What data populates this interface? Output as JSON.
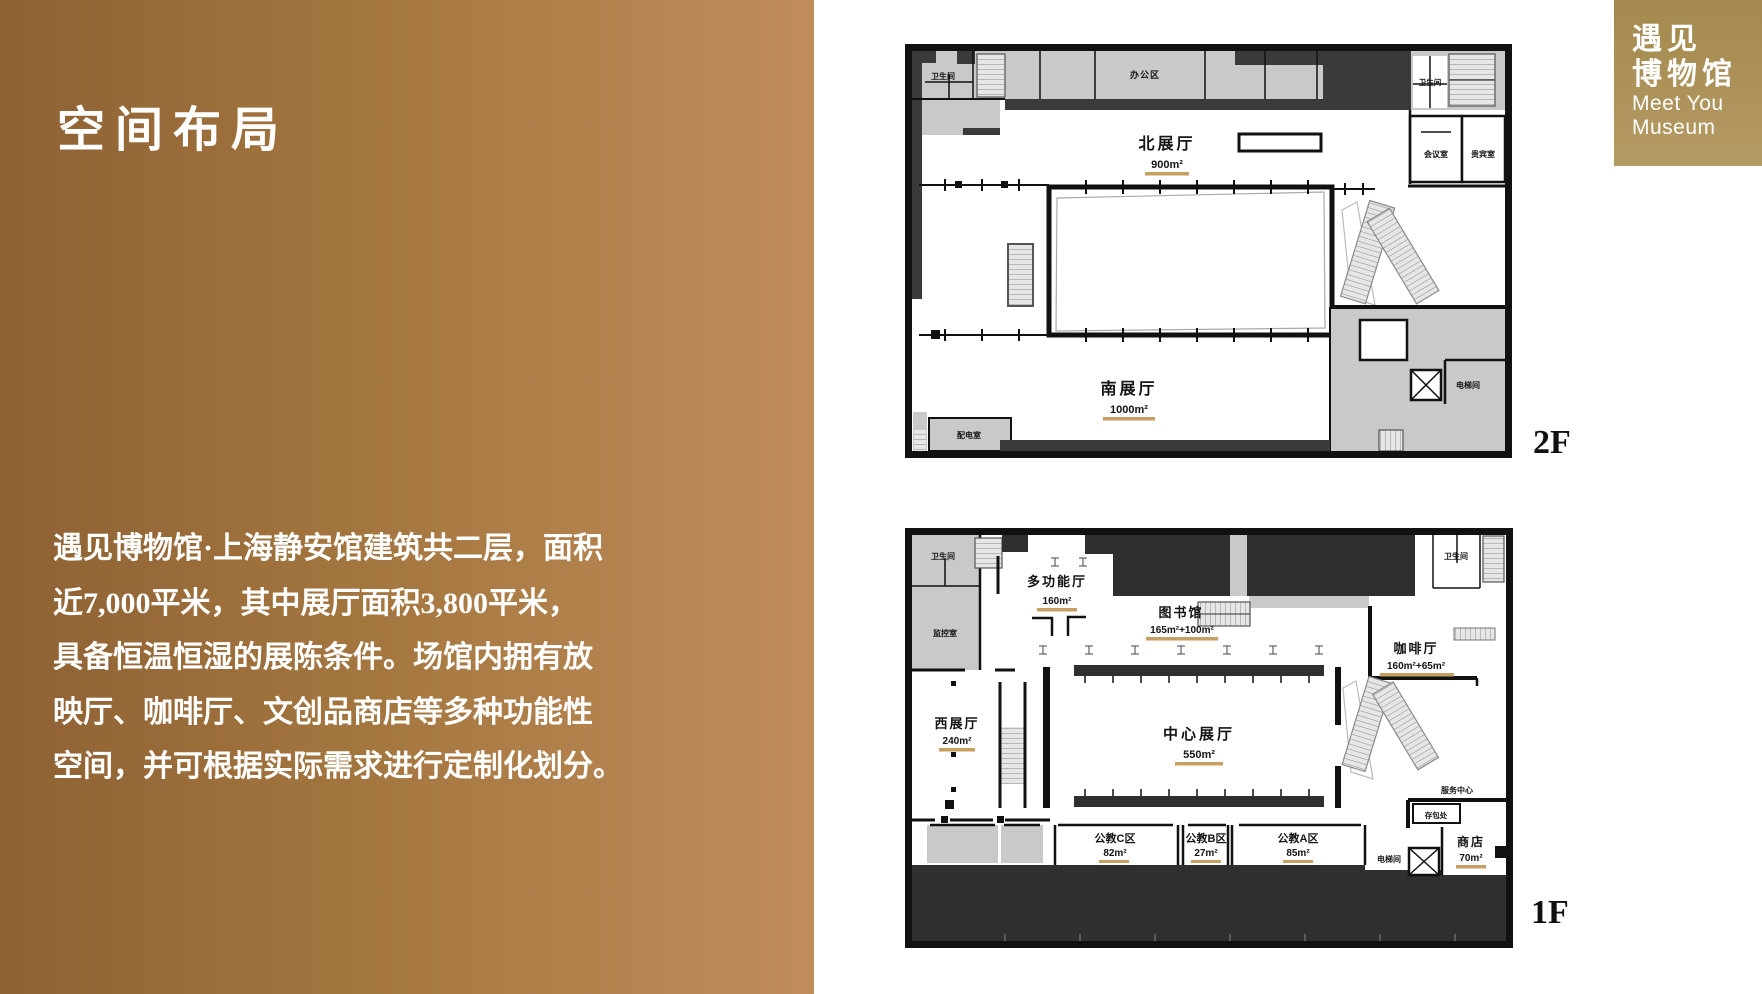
{
  "left_panel": {
    "title": "空间布局",
    "paragraph_lines": [
      "遇见博物馆·上海静安馆建筑共二层，面积",
      "近7,000平米，其中展厅面积3,800平米，",
      "具备恒温恒湿的展陈条件。场馆内拥有放",
      "映厅、咖啡厅、文创品商店等多种功能性",
      "空间，并可根据实际需求进行定制化划分。"
    ]
  },
  "logo": {
    "cn_line1": "遇见",
    "cn_line2": "博物馆",
    "en_line1": "Meet You",
    "en_line2": "Museum"
  },
  "floor2": {
    "floor_label": "2F",
    "rooms": {
      "toilet_left": "卫生间",
      "office": "办公区",
      "toilet_right": "卫生间",
      "meeting": "会议室",
      "vip": "贵宾室",
      "north_hall": {
        "name": "北展厅",
        "area": "900m²"
      },
      "south_hall": {
        "name": "南展厅",
        "area": "1000m²"
      },
      "power": "配电室",
      "elevator": "电梯间"
    }
  },
  "floor1": {
    "floor_label": "1F",
    "rooms": {
      "toilet_left": "卫生间",
      "monitor": "监控室",
      "multi_hall": {
        "name": "多功能厅",
        "area": "160m²"
      },
      "library": {
        "name": "图书馆",
        "area": "165m²+100m²"
      },
      "toilet_right": "卫生间",
      "cafe": {
        "name": "咖啡厅",
        "area": "160m²+65m²"
      },
      "west_hall": {
        "name": "西展厅",
        "area": "240m²"
      },
      "center_hall": {
        "name": "中心展厅",
        "area": "550m²"
      },
      "service": "服务中心",
      "locker": "存包处",
      "shop": {
        "name": "商店",
        "area": "70m²"
      },
      "elevator": "电梯间",
      "edu_c": {
        "name": "公教C区",
        "area": "82m²"
      },
      "edu_b": {
        "name": "公教B区",
        "area": "27m²"
      },
      "edu_a": {
        "name": "公教A区",
        "area": "85m²"
      }
    }
  },
  "colors": {
    "panel_gradient_start": "#8e6134",
    "panel_gradient_end": "#c08d5b",
    "logo_gold": "#a4894d",
    "area_underline": "#c89f63",
    "plan_light_gray": "#c9c9c9",
    "plan_dark_gray": "#3a3a3a",
    "plan_dark_fill": "#2f2f2f"
  }
}
